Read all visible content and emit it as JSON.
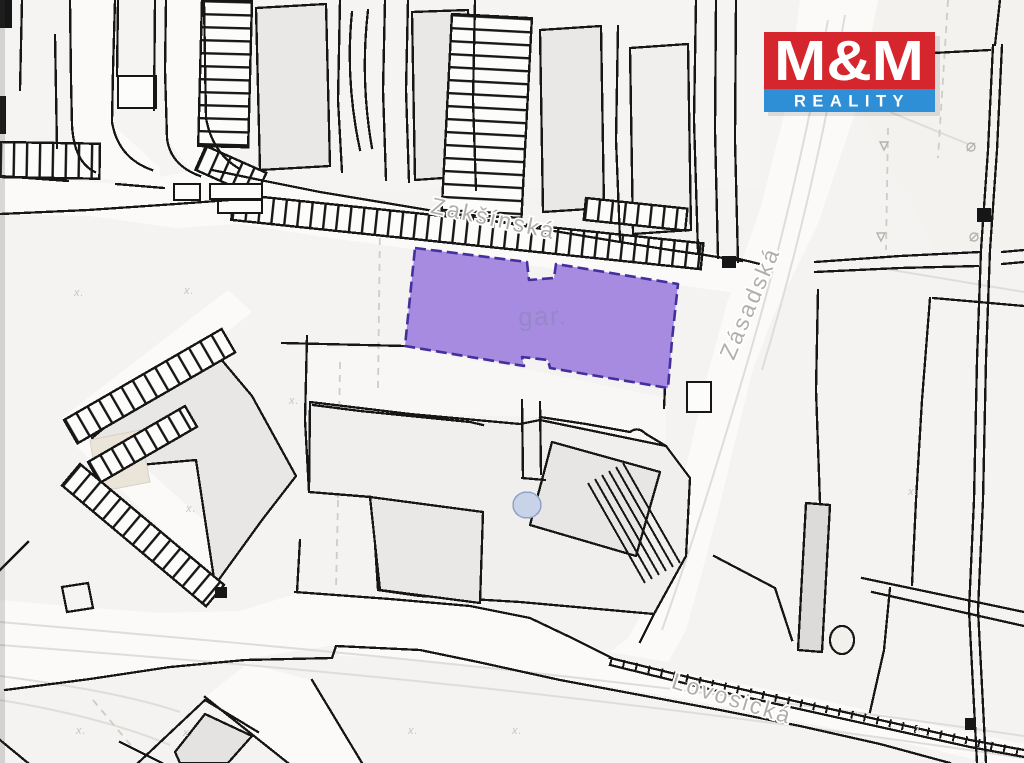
{
  "logo": {
    "name": "M&M",
    "tagline": "REALITY",
    "red": "#d5262d",
    "blue": "#2e8ed6",
    "text_color": "#ffffff"
  },
  "map": {
    "background": "#f4f3f1",
    "line_color": "#161616",
    "street_fill": "#fbfaf9",
    "label_color": "#b2afaa",
    "streets": {
      "zaksinska": "Zakšínská",
      "zasadska": "Zásadská",
      "lovosicka": "Lovosická"
    },
    "highlighted_parcel": {
      "label": "gar.",
      "fill": "#a78be0",
      "stroke": "#43309e",
      "label_color": "#9488c4"
    },
    "survey_mark": "x."
  }
}
